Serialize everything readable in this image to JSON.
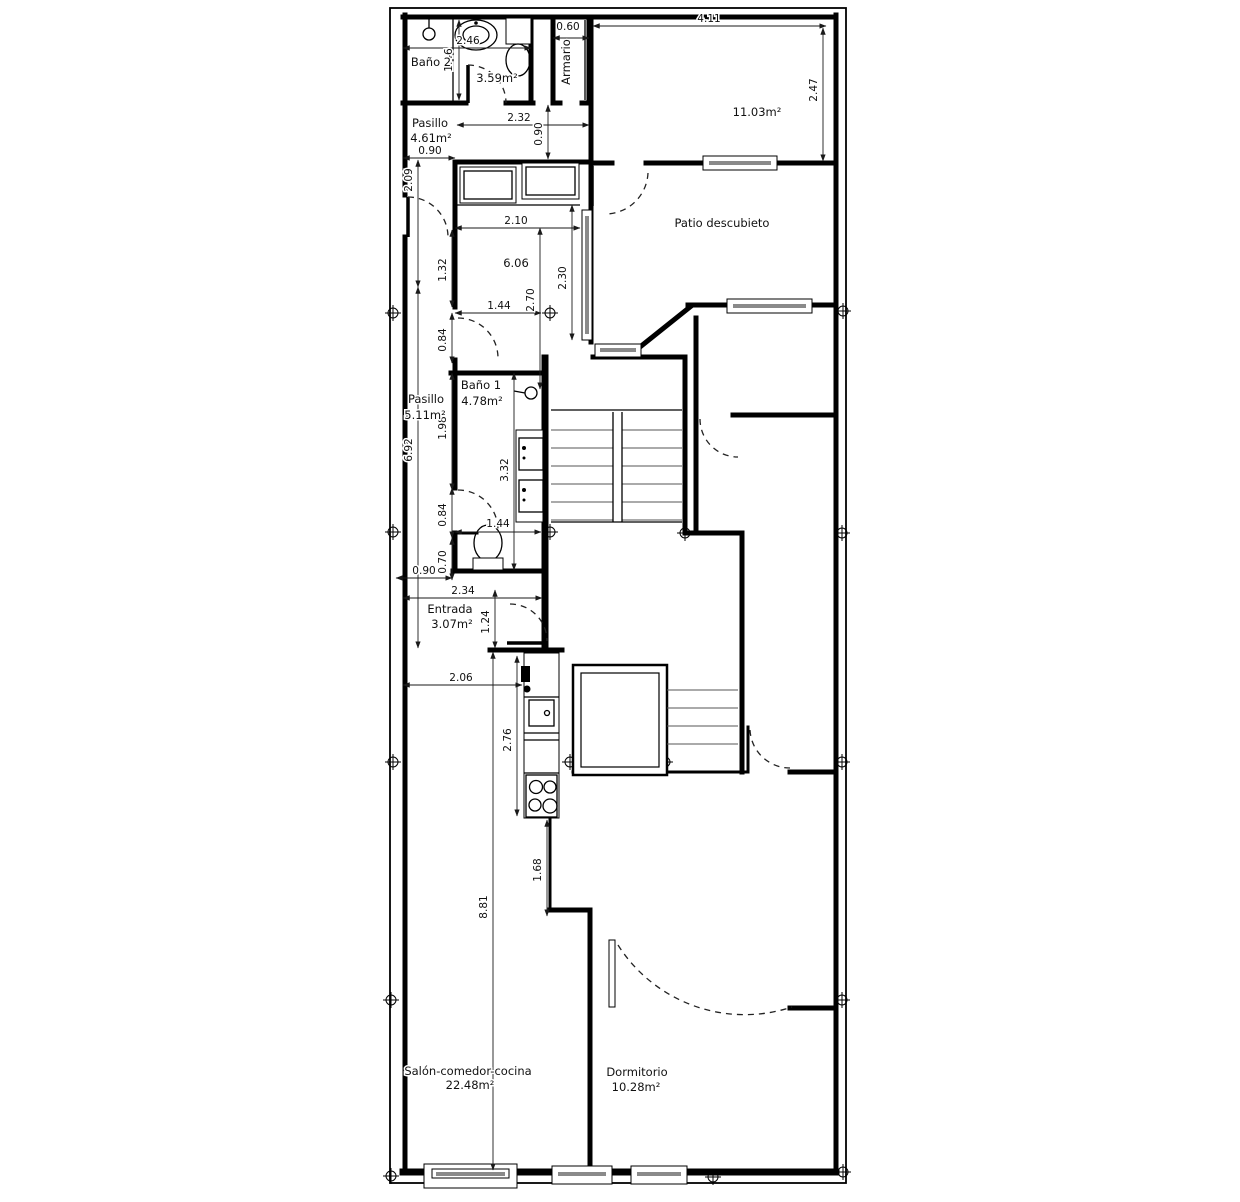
{
  "plan": {
    "rooms": [
      {
        "name": "Baño 2",
        "area": "3.59m²"
      },
      {
        "name": "Armario",
        "area": ""
      },
      {
        "name": "",
        "area": "11.03m²"
      },
      {
        "name": "Patio descubieto",
        "area": ""
      },
      {
        "name": "Pasillo",
        "area": "4.61m²"
      },
      {
        "name": "",
        "area": "6.06"
      },
      {
        "name": "Baño 1",
        "area": "4.78m²"
      },
      {
        "name": "Pasillo",
        "area": "5.11m²"
      },
      {
        "name": "Entrada",
        "area": "3.07m²"
      },
      {
        "name": "Salón-comedor-cocina",
        "area": "22.48m²"
      },
      {
        "name": "Dormitorio",
        "area": "10.28m²"
      }
    ],
    "dimensions": {
      "d246": "2.46",
      "d146": "1.46",
      "d060": "0.60",
      "d411": "4.11",
      "d247": "2.47",
      "d232": "2.32",
      "d090a": "0.90",
      "d090b": "0.90",
      "d209": "2.09",
      "d692": "6.92",
      "d210": "2.10",
      "d270": "2.70",
      "d230": "2.30",
      "d132": "1.32",
      "d144a": "1.44",
      "d084a": "0.84",
      "d198": "1.98",
      "d332": "3.32",
      "d084b": "0.84",
      "d144b": "1.44",
      "d070": "0.70",
      "d090c": "0.90",
      "d234": "2.34",
      "d124": "1.24",
      "d206": "2.06",
      "d276": "2.76",
      "d168": "1.68",
      "d881": "8.81"
    },
    "colors": {
      "wall": "#000000",
      "dimension": "#1a1a1a",
      "window_fill": "#8a8a8a",
      "background": "#ffffff"
    }
  }
}
